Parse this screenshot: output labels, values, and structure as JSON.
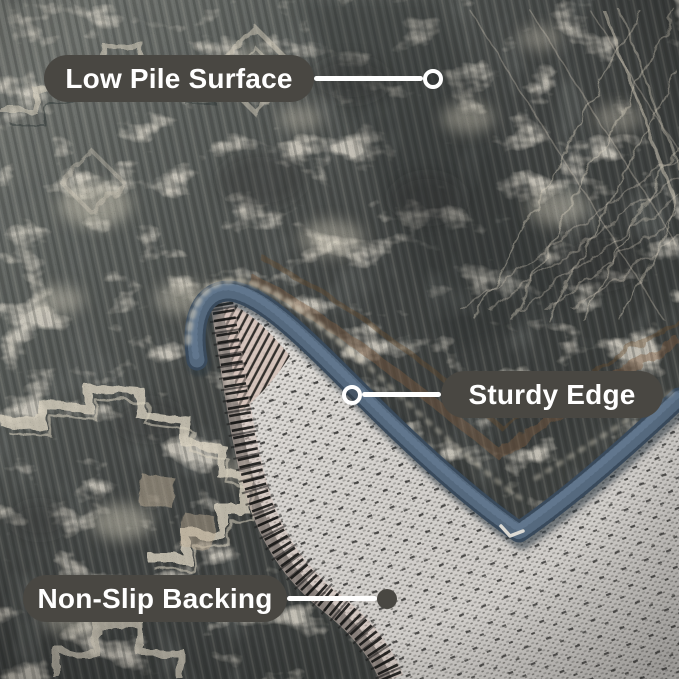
{
  "photo": {
    "subject": "Folded corner of a distressed vintage gray area rug showing the low-pile front, navy serged edge and woven non-slip backing"
  },
  "colors": {
    "callout_bg": "#494742",
    "callout_text": "#ffffff",
    "connector": "#ffffff",
    "binding_navy": "#394a5c",
    "binding_navy_light": "#5c7087",
    "binding_navy_dark": "#24303d",
    "rug_mid": "#64686a",
    "rug_dark": "#3a3d3c",
    "rug_cream": "#d9d2c0",
    "rug_tan": "#c0b097",
    "stripe_brown": "#7b5a3b",
    "backing_light": "#e3e0dc",
    "backing_weave": "#8f8d89",
    "backing_pink": "#d5c2b9",
    "stitch_black": "#161615"
  },
  "callouts": {
    "low_pile": {
      "label": "Low Pile Surface",
      "endpoint": "ring"
    },
    "sturdy_edge": {
      "label": "Sturdy Edge",
      "endpoint": "ring"
    },
    "non_slip": {
      "label": "Non-Slip Backing",
      "endpoint": "dot"
    }
  }
}
